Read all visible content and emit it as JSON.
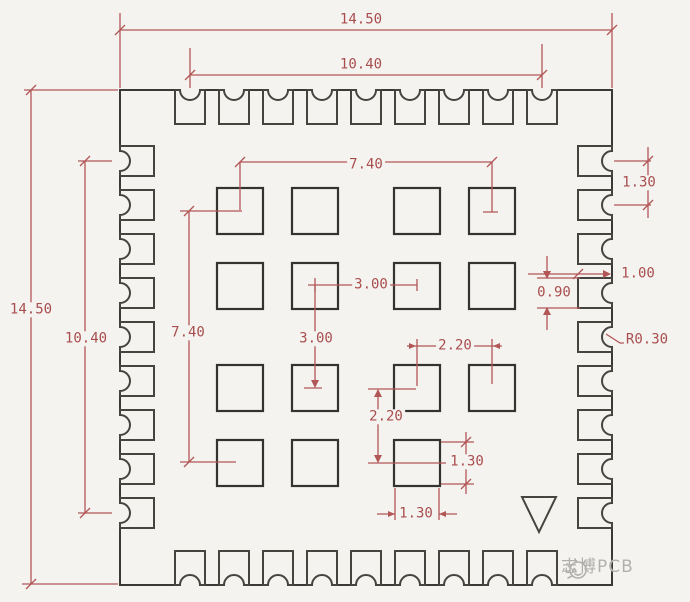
{
  "title": "PCB module footprint dimension drawing",
  "colors": {
    "dimension_red": "#b25656",
    "outline_dark": "#45443f",
    "background": "#f5f3f0",
    "watermark_gray": "#b2b0ac"
  },
  "dimensions": {
    "top_outer": "14.50",
    "top_inner": "10.40",
    "left_outer": "14.50",
    "left_inner": "10.40",
    "grid_span_h": "7.40",
    "grid_span_v": "7.40",
    "center_pitch_h": "3.00",
    "center_pitch_v": "3.00",
    "pitch_h": "2.20",
    "pitch_v": "2.20",
    "pad_height": "1.30",
    "pad_width": "1.30",
    "edge_pad_pitch": "1.30",
    "edge_pad_depth": "1.00",
    "edge_pad_width": "0.90",
    "notch_radius": "R0.30"
  },
  "watermark": {
    "icon": "sun-doodle-icon",
    "text": "志博PCB"
  }
}
